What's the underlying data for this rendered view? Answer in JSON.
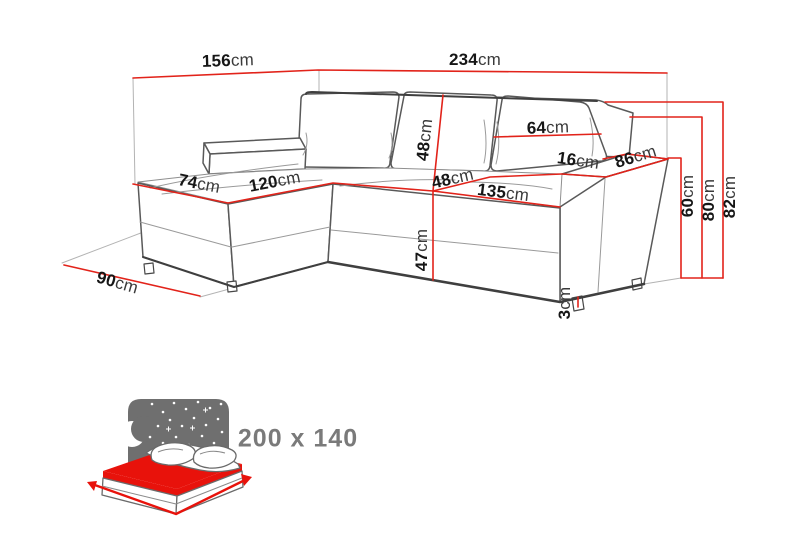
{
  "colors": {
    "dimension_red": "#e2231a",
    "sofa_outline": "#595959",
    "sofa_outline_dark": "#3f3f3f",
    "guide_gray": "#b3b3b3",
    "detail_gray": "#9a9a9a",
    "label_color": "#161616",
    "unit_color": "#3a3a3a",
    "icon_gray": "#6f6f6f",
    "icon_red": "#e8120b",
    "icon_text": "#7a7a7a"
  },
  "dimensions": {
    "chaise_side_width": {
      "value": "156",
      "unit": "cm"
    },
    "total_width": {
      "value": "234",
      "unit": "cm"
    },
    "back_cushion_height": {
      "value": "48",
      "unit": "cm"
    },
    "cushion_width": {
      "value": "64",
      "unit": "cm"
    },
    "armrest_width": {
      "value": "16",
      "unit": "cm"
    },
    "armrest_depth": {
      "value": "86",
      "unit": "cm"
    },
    "chaise_seat_width": {
      "value": "74",
      "unit": "cm"
    },
    "chaise_seat_length": {
      "value": "120",
      "unit": "cm"
    },
    "seat_depth": {
      "value": "48",
      "unit": "cm"
    },
    "seat_length": {
      "value": "135",
      "unit": "cm"
    },
    "armrest_height": {
      "value": "60",
      "unit": "cm"
    },
    "backrest_height": {
      "value": "80",
      "unit": "cm"
    },
    "total_height": {
      "value": "82",
      "unit": "cm"
    },
    "seat_height": {
      "value": "47",
      "unit": "cm"
    },
    "leg_height": {
      "value": "3",
      "unit": "cm"
    },
    "chaise_footprint_depth": {
      "value": "90",
      "unit": "cm"
    }
  },
  "bed_icon": {
    "sleeping_area_label": "200 x 140"
  }
}
